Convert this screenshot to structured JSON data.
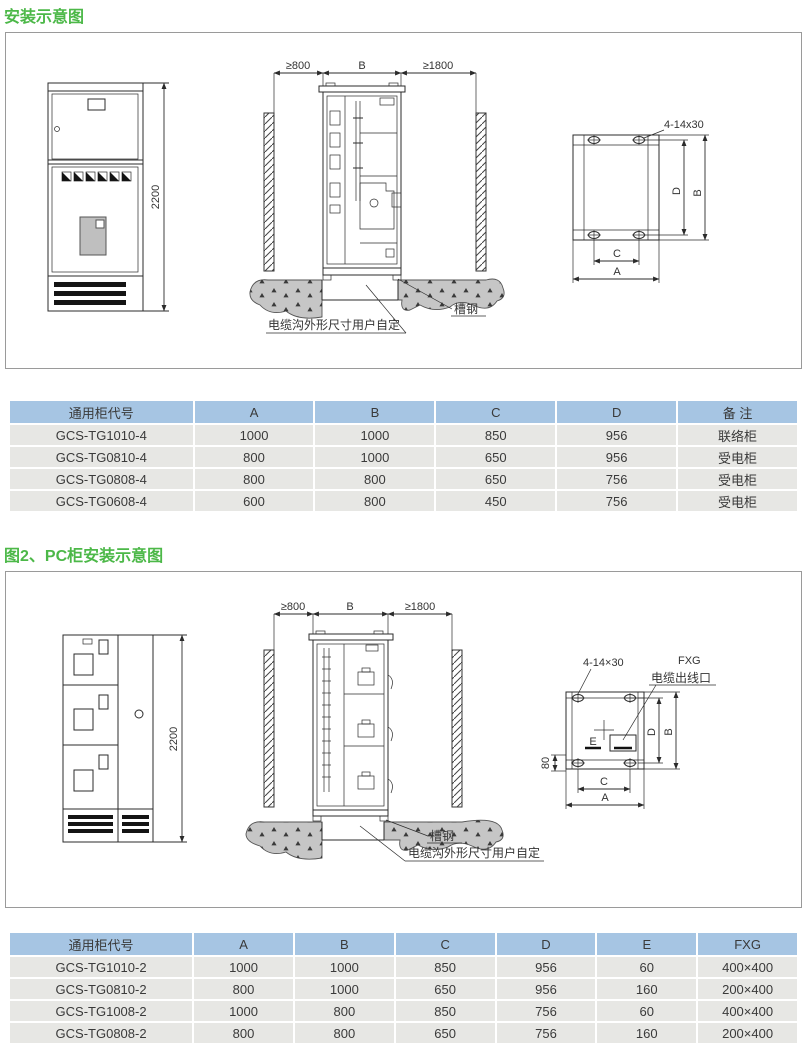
{
  "page": {
    "fig1": {
      "title": "安装示意图",
      "front_view": {
        "height_dim": "2200"
      },
      "install_view": {
        "dim_left": "≥800",
        "dim_mid": "B",
        "dim_right": "≥1800",
        "channel_steel_label": "槽钢",
        "trench_label": "电缆沟外形尺寸用户自定"
      },
      "mount_view": {
        "bolt_label": "4-14x30",
        "dim_d": "D",
        "dim_b": "B",
        "dim_c": "C",
        "dim_a": "A"
      },
      "table": {
        "headers": [
          "通用柜代号",
          "A",
          "B",
          "C",
          "D",
          "备 注"
        ],
        "rows": [
          [
            "GCS-TG1010-4",
            "1000",
            "1000",
            "850",
            "956",
            "联络柜"
          ],
          [
            "GCS-TG0810-4",
            "800",
            "1000",
            "650",
            "956",
            "受电柜"
          ],
          [
            "GCS-TG0808-4",
            "800",
            "800",
            "650",
            "756",
            "受电柜"
          ],
          [
            "GCS-TG0608-4",
            "600",
            "800",
            "450",
            "756",
            "受电柜"
          ]
        ]
      }
    },
    "fig2": {
      "title": "图2、PC柜安装示意图",
      "front_view": {
        "height_dim": "2200"
      },
      "install_view": {
        "dim_left": "≥800",
        "dim_mid": "B",
        "dim_right": "≥1800",
        "channel_steel_label": "槽钢",
        "trench_label": "电缆沟外形尺寸用户自定"
      },
      "mount_view": {
        "bolt_label": "4-14×30",
        "fxg_label": "FXG",
        "outlet_label": "电缆出线口",
        "dim_e": "E",
        "dim_80": "80",
        "dim_d": "D",
        "dim_b": "B",
        "dim_c": "C",
        "dim_a": "A"
      },
      "table": {
        "headers": [
          "通用柜代号",
          "A",
          "B",
          "C",
          "D",
          "E",
          "FXG"
        ],
        "rows": [
          [
            "GCS-TG1010-2",
            "1000",
            "1000",
            "850",
            "956",
            "60",
            "400×400"
          ],
          [
            "GCS-TG0810-2",
            "800",
            "1000",
            "650",
            "956",
            "160",
            "200×400"
          ],
          [
            "GCS-TG1008-2",
            "1000",
            "800",
            "850",
            "756",
            "60",
            "400×400"
          ],
          [
            "GCS-TG0808-2",
            "800",
            "800",
            "650",
            "756",
            "160",
            "200×400"
          ]
        ]
      }
    },
    "colors": {
      "accent_green": "#4CB848",
      "table_header_bg": "#A6C5E3",
      "table_row_bg": "#E7E7E4"
    }
  }
}
